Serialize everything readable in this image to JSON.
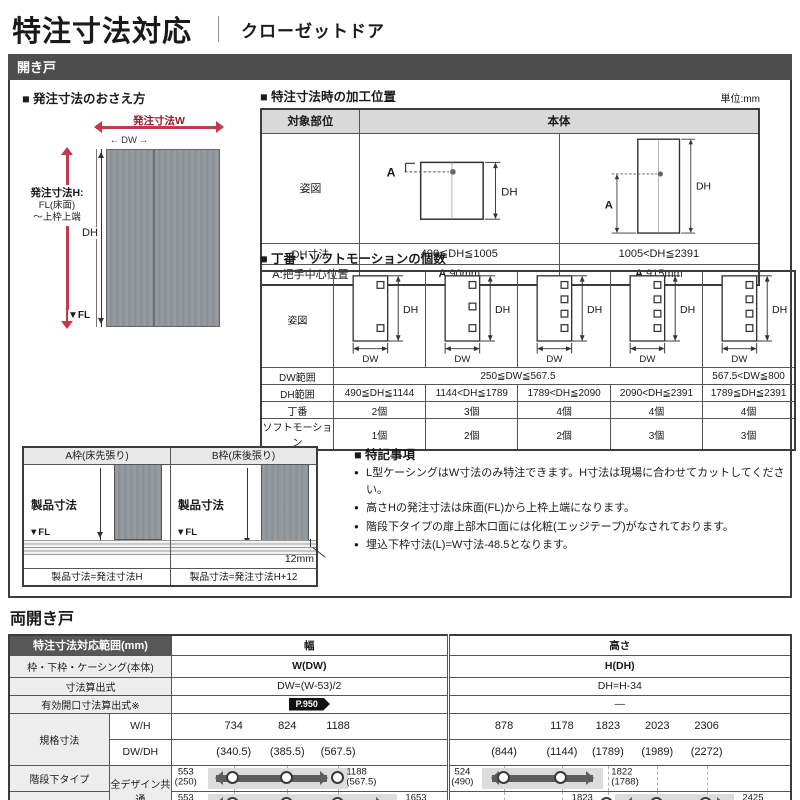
{
  "page": {
    "title": "特注寸法対応",
    "subtitle": "クローゼットドア",
    "section_hinged": "開き戸",
    "section_double": "両開き戸",
    "unit": "単位:mm"
  },
  "measure": {
    "heading": "■ 発注寸法のおさえ方",
    "w_label": "発注寸法W",
    "dw_label": "DW",
    "h_label": "発注寸法H:",
    "h_sub1": "FL(床面)",
    "h_sub2": "〜上枠上端",
    "dh_label": "DH",
    "fl_label": "▼FL"
  },
  "processing": {
    "heading": "■ 特注寸法時の加工位置",
    "col_part": "対象部位",
    "col_body": "本体",
    "row_figure": "姿図",
    "row_dh": "DH寸法",
    "dh_small": "490≦DH≦1005",
    "dh_large": "1005<DH≦2391",
    "row_a": "A:把手中心位置",
    "a_prefix": "A",
    "a_small": ":90mm",
    "a_large": ":915mm",
    "diag_a": "A",
    "diag_dh": "DH"
  },
  "hinge": {
    "heading": "■ 丁番・ソフトモーションの個数",
    "row_figure": "姿図",
    "row_dw": "DW範囲",
    "row_dh": "DH範囲",
    "row_hinge": "丁番",
    "row_soft": "ソフトモーション",
    "dw_main": "250≦DW≦567.5",
    "dw_last": "567.5<DW≦800",
    "dh_ranges": [
      "490≦DH≦1144",
      "1144<DH≦1789",
      "1789<DH≦2090",
      "2090<DH≦2391",
      "1789≦DH≦2391"
    ],
    "hinge_counts": [
      "2個",
      "3個",
      "4個",
      "4個",
      "4個"
    ],
    "soft_counts": [
      "1個",
      "2個",
      "2個",
      "3個",
      "3個"
    ],
    "squares": [
      2,
      3,
      4,
      4,
      4
    ],
    "dh": "DH",
    "dw": "DW"
  },
  "frames": {
    "a_title": "A枠(床先張り)",
    "b_title": "B枠(床後張り)",
    "product": "製品寸法",
    "fl": "▼FL",
    "offset": "12mm",
    "a_caption": "製品寸法=発注寸法H",
    "b_caption": "製品寸法=発注寸法H+12"
  },
  "notes": {
    "heading": "■ 特記事項",
    "items": [
      "L型ケーシングはW寸法のみ特注できます。H寸法は現場に合わせてカットしてください。",
      "高さHの発注寸法は床面(FL)から上枠上端になります。",
      "階段下タイプの扉上部木口面には化粧(エッジテープ)がなされております。",
      "埋込下枠寸法(L)=W寸法-48.5となります。"
    ]
  },
  "dd": {
    "range_header": "特注寸法対応範囲(mm)",
    "width_header": "幅",
    "height_header": "高さ",
    "frame_row": "枠・下枠・ケーシング(本体)",
    "w_dw": "W(DW)",
    "h_dh": "H(DH)",
    "calc_row": "寸法算出式",
    "w_calc": "DW=(W-53)/2",
    "h_calc": "DH=H-34",
    "open_row": "有効開口寸法算出式※",
    "page_badge": "P.950",
    "h_open": "—",
    "std_row": "規格寸法",
    "wh": "W/H",
    "dwdh": "DW/DH",
    "w_vals": [
      "734",
      "824",
      "1188"
    ],
    "w_sub": [
      "(340.5)",
      "(385.5)",
      "(567.5)"
    ],
    "h_vals": [
      "878",
      "1178",
      "1823",
      "2023",
      "2306"
    ],
    "h_sub": [
      "(844)",
      "(1144)",
      "(1789)",
      "(1989)",
      "(2272)"
    ],
    "stair_row": "階段下タイプ",
    "standard_row": "標準タイプ",
    "common": "全デザイン共通",
    "w_stair_min": "553",
    "w_stair_min2": "(250)",
    "w_stair_max": "1188",
    "w_stair_max2": "(567.5)",
    "w_std_min": "553",
    "w_std_min2": "(250)",
    "w_std_max": "1653",
    "w_std_max2": "(800)",
    "h_stair_min": "524",
    "h_stair_min2": "(490)",
    "h_stair_max": "1822",
    "h_stair_max2": "(1788)",
    "h_std_min": "1823",
    "h_std_min2": "(1789)",
    "h_std_max": "2425",
    "h_std_max2": "(2391)"
  },
  "footnote": "※ソフトモーションのありなしで、有効開口寸法が変わります。"
}
